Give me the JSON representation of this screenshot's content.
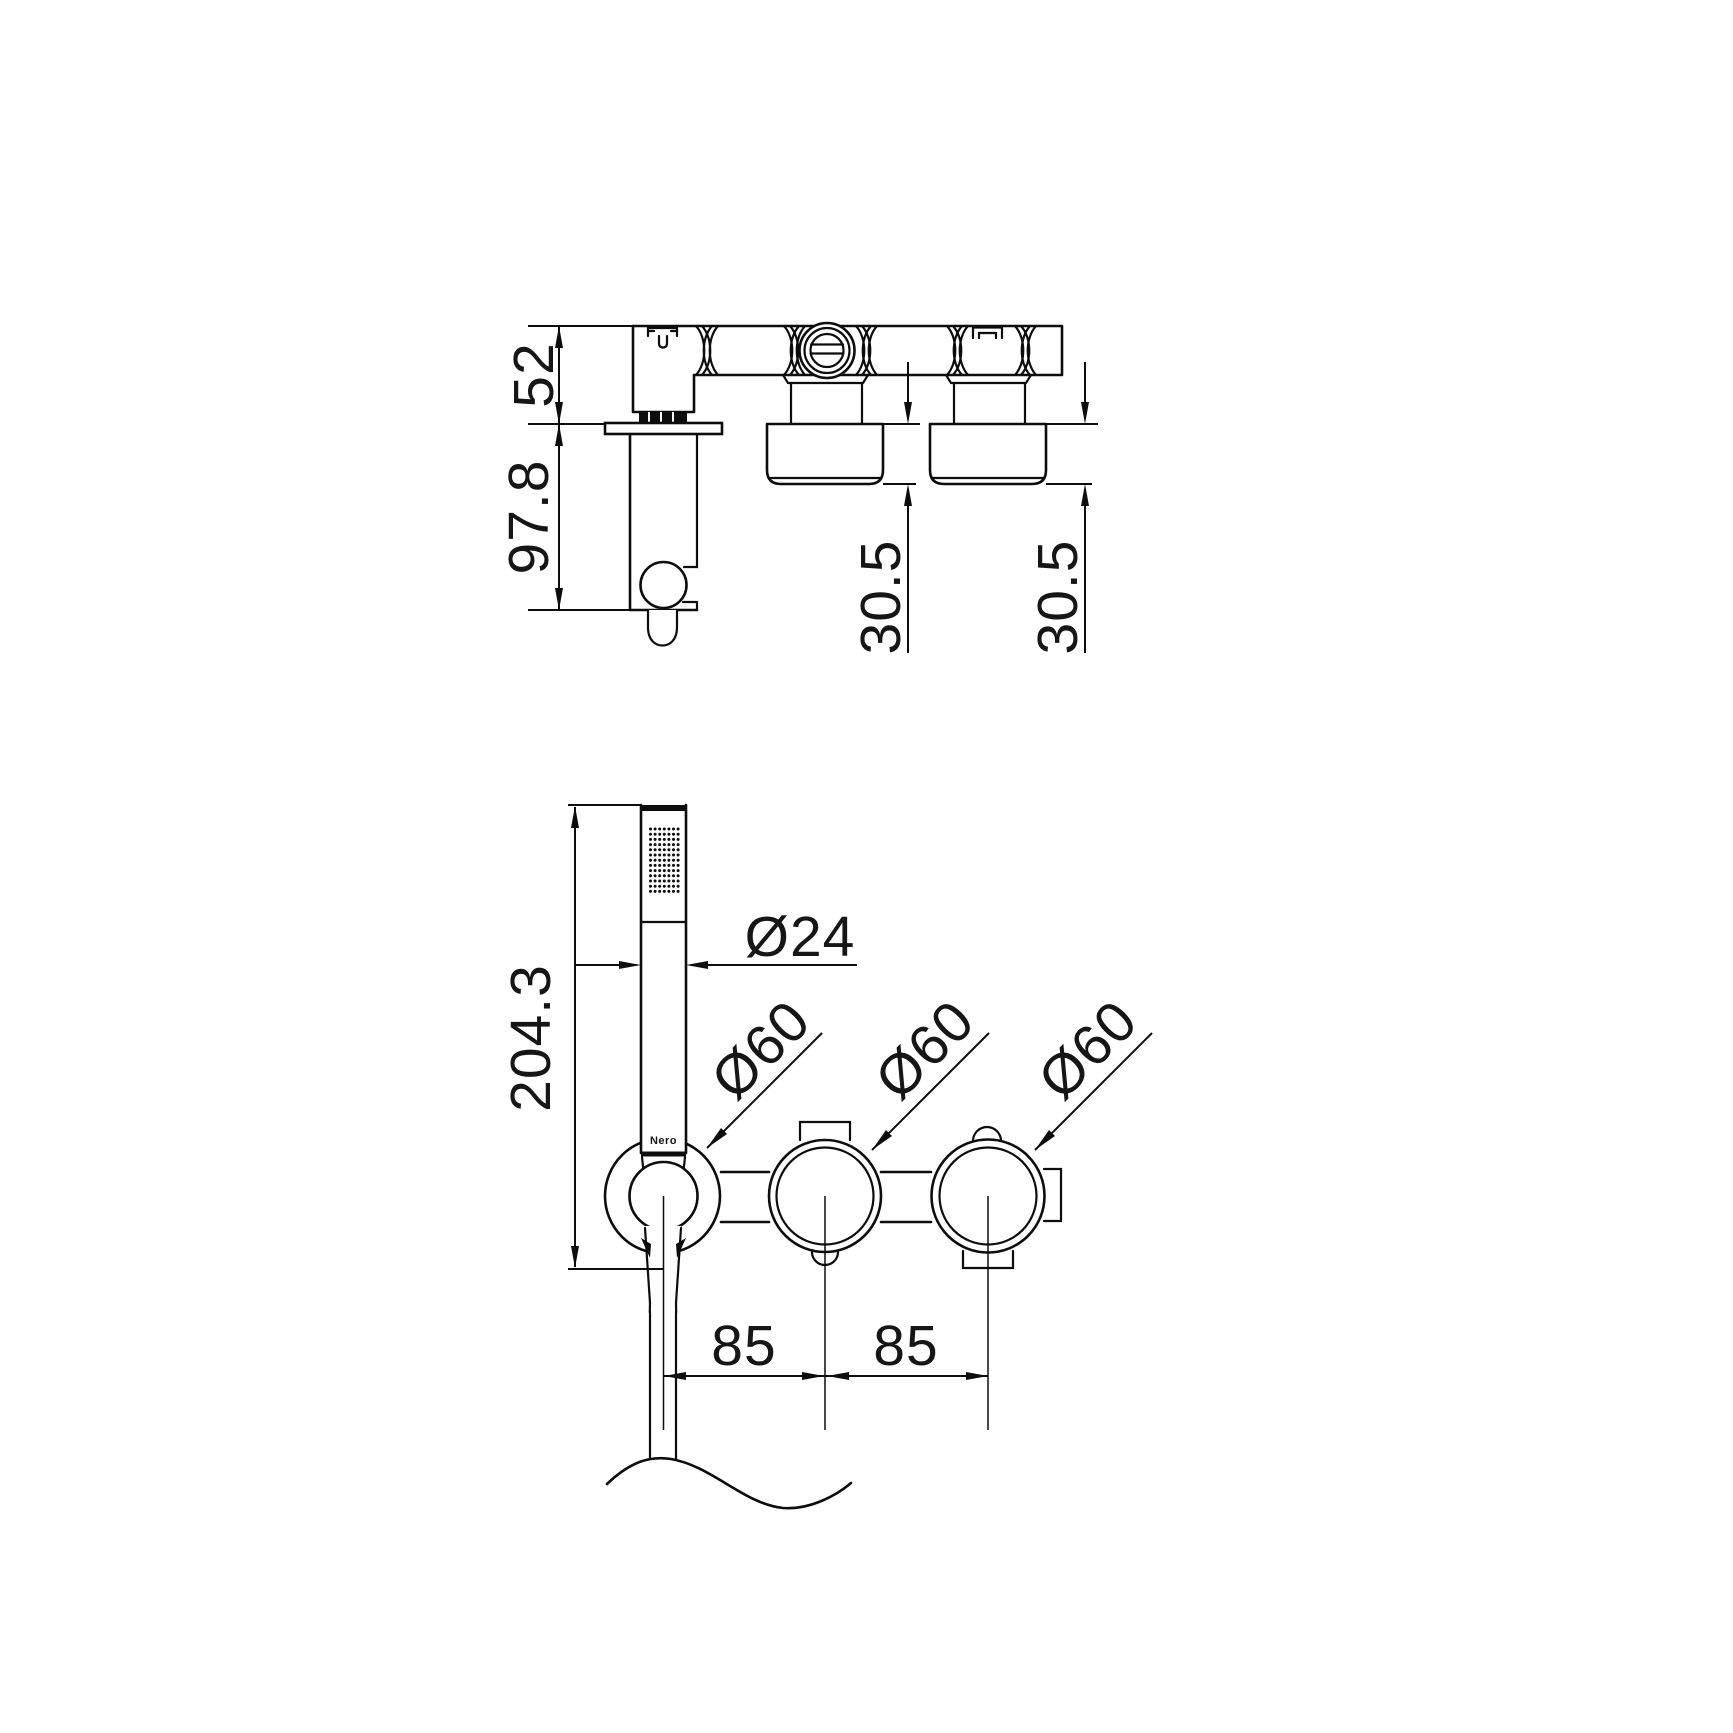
{
  "drawing": {
    "brand_label": "Nero",
    "line_color": "#0d0d0d",
    "background_color": "#ffffff",
    "side_view": {
      "dim_height_upper": "52",
      "dim_height_lower": "97.8",
      "dim_depth": [
        "30.5",
        "30.5"
      ]
    },
    "front_view": {
      "dim_handshower_length": "204.3",
      "dim_handshower_diameter": "Ø24",
      "dim_rosette_diameters": [
        "Ø60",
        "Ø60",
        "Ø60"
      ],
      "dim_spacings": [
        "85",
        "85"
      ]
    }
  }
}
